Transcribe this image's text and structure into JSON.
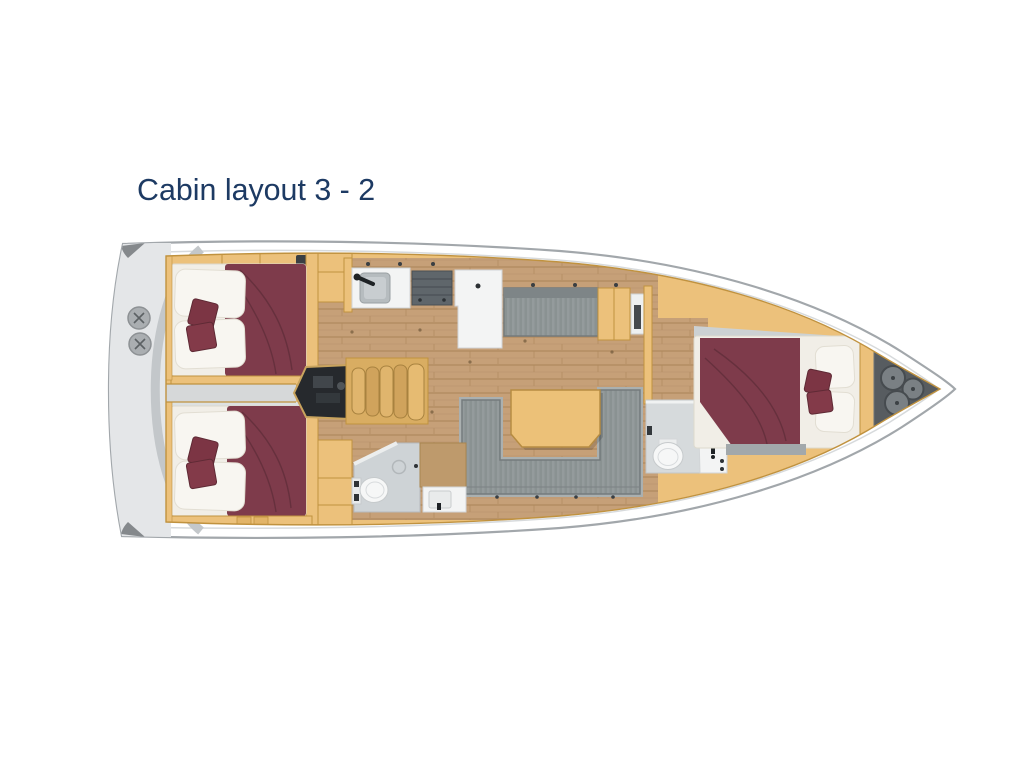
{
  "header": {
    "title": "Cabin layout 3 - 2"
  },
  "diagram": {
    "type": "yacht-floor-plan",
    "orientation": "bow-right",
    "areas": {
      "cockpit": "Aft cockpit with twin helm wheels",
      "aft_cabin_port": "Aft double cabin (port)",
      "aft_cabin_starboard": "Aft double cabin (starboard)",
      "engine_compartment": "Engine compartment",
      "companionway_stairs": "Companionway steps",
      "galley": "Galley with sink, stove and counter",
      "settee_port": "Straight settee (port)",
      "salon_sofa": "U-shaped salon sofa",
      "salon_table": "Salon table",
      "aft_head": "Aft bathroom with toilet, shower and vanity",
      "forward_head": "Forward bathroom with toilet and sink",
      "forward_cabin": "Forward double cabin",
      "anchor_locker": "Bow anchor locker with rope hatches"
    }
  },
  "colors": {
    "title-color": "#1d3a63",
    "tan": "#ecc17b",
    "tan-edge": "#c0923f",
    "wood": "#c6a078",
    "maroon": "#7e3b4b",
    "mattress": "#f1eee7",
    "pillow": "#f8f6f1",
    "sofa-gray": "#8f9697",
    "deck-gray": "#e4e6e8",
    "hull-line": "#a2a7ab",
    "engine": "#26292d",
    "anchor": "#575c60"
  }
}
